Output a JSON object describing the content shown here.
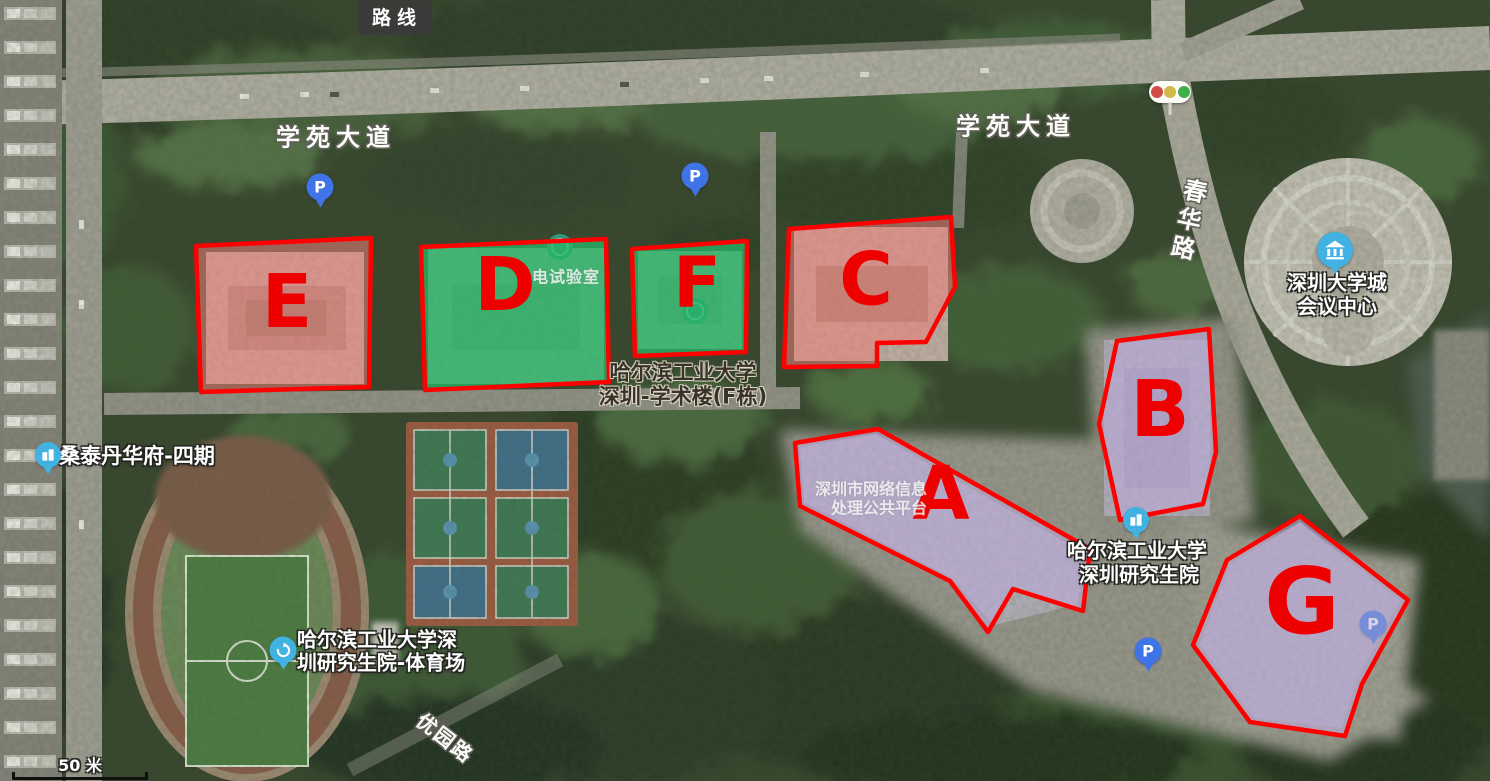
{
  "map": {
    "route_button_label": "路线",
    "scale_label": "50 米"
  },
  "roads": {
    "xueyuan_avenue_west": "学苑大道",
    "xueyuan_avenue_east": "学苑大道",
    "chunhua_road": "春华路",
    "youyuan_road": "优园路"
  },
  "regions": [
    {
      "letter": "A",
      "fill": "purple"
    },
    {
      "letter": "B",
      "fill": "purple"
    },
    {
      "letter": "C",
      "fill": "pink"
    },
    {
      "letter": "D",
      "fill": "green"
    },
    {
      "letter": "E",
      "fill": "pink"
    },
    {
      "letter": "F",
      "fill": "green"
    },
    {
      "letter": "G",
      "fill": "purple"
    }
  ],
  "colors": {
    "region_border": "#ff0000",
    "region_letter": "#ee0000",
    "pink_fill": "#ec807a",
    "green_fill": "#27b567",
    "purple_fill": "#bcaad6"
  },
  "labels": {
    "conference_center_line1": "深圳大学城",
    "conference_center_line2": "会议中心",
    "lab": "电试验室",
    "academic_line1": "哈尔滨工业大学",
    "academic_line2": "深圳-学术楼(F栋)",
    "santai": "桑泰丹华府-四期",
    "stadium_line1": "哈尔滨工业大学深",
    "stadium_line2": "圳研究生院-体育场",
    "network_line1": "深圳市网络信息",
    "network_line2": "处理公共平台",
    "graduate_line1": "哈尔滨工业大学",
    "graduate_line2": "深圳研究生院"
  },
  "icons": {
    "parking_glyph": "P"
  }
}
